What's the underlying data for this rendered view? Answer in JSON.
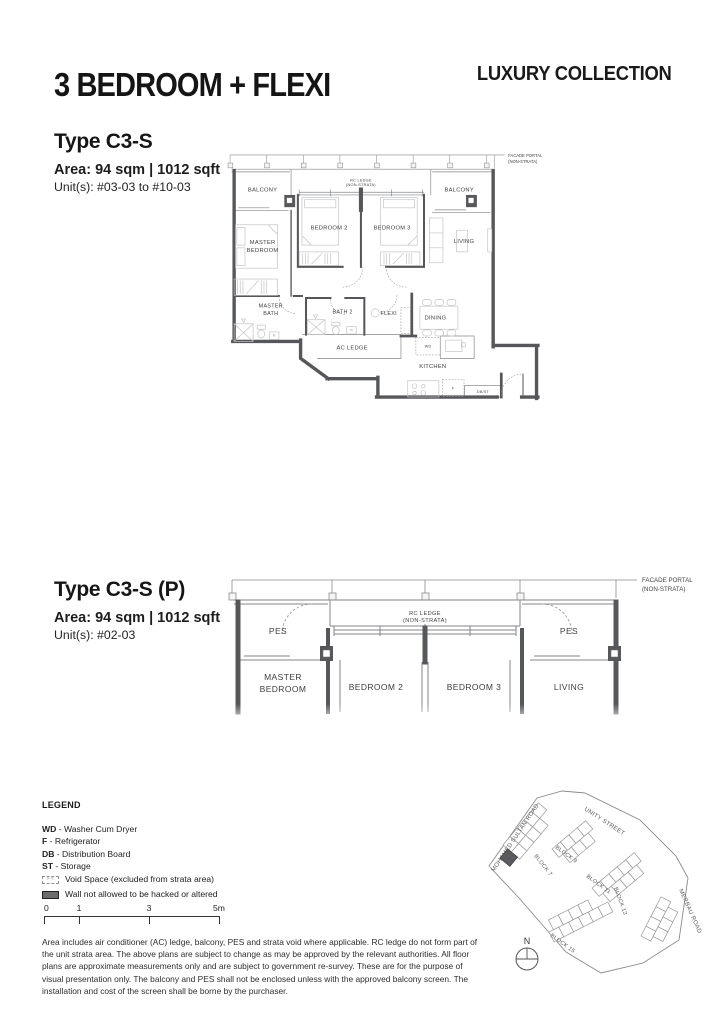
{
  "header": {
    "title": "3 BEDROOM + FLEXI",
    "collection": "LUXURY COLLECTION"
  },
  "plan1": {
    "type": "Type C3-S",
    "area": "Area: 94 sqm | 1012 sqft",
    "units": "Unit(s): #03-03 to #10-03",
    "labels": {
      "facade1": "FACADE PORTAL",
      "facade2": "(NON-STRATA)",
      "rc1": "RC LEDGE",
      "rc2": "(NON-STRATA)",
      "balcony_left": "BALCONY",
      "balcony_right": "BALCONY",
      "master1": "MASTER",
      "master2": "BEDROOM",
      "bedroom2": "BEDROOM 2",
      "bedroom3": "BEDROOM 3",
      "living": "LIVING",
      "mbath1": "MASTER",
      "mbath2": "BATH",
      "bath2": "BATH 2",
      "flexi": "FLEXI",
      "dining": "DINING",
      "ac_ledge": "AC LEDGE",
      "wd": "WD",
      "kitchen": "KITCHEN",
      "f": "F",
      "dbst": "DB/ST"
    }
  },
  "plan2": {
    "type": "Type C3-S (P)",
    "area": "Area: 94 sqm | 1012 sqft",
    "units": "Unit(s): #02-03",
    "labels": {
      "facade1": "FACADE PORTAL",
      "facade2": "(NON-STRATA)",
      "rc1": "RC LEDGE",
      "rc2": "(NON-STRATA)",
      "pes_left": "PES",
      "pes_right": "PES",
      "master1": "MASTER",
      "master2": "BEDROOM",
      "bedroom2": "BEDROOM 2",
      "bedroom3": "BEDROOM 3",
      "living": "LIVING"
    }
  },
  "legend": {
    "heading": "LEGEND",
    "items": [
      {
        "abbr": "WD",
        "rest": " - Washer Cum Dryer"
      },
      {
        "abbr": "F",
        "rest": " - Refrigerator"
      },
      {
        "abbr": "DB",
        "rest": " - Distribution Board"
      },
      {
        "abbr": "ST",
        "rest": " - Storage"
      }
    ],
    "void_glyph": "><",
    "void_space": "Void Space (excluded from strata area)",
    "wall_rule": "Wall not allowed to be hacked or altered"
  },
  "scalebar": {
    "labels": [
      "0",
      "1",
      "3",
      "5m"
    ]
  },
  "disclaimer": "Area includes air conditioner (AC) ledge, balcony, PES and strata void where applicable. RC ledge do not form part of the unit strata area. The above plans are subject to change as may be approved by the relevant authorities. All floor plans are approximate measurements only and are subject to government re-survey. These are for the purpose of visual presentation only. The balcony and PES shall not be enclosed unless with the approved balcony screen. The installation and cost of the screen shall be borne by the purchaser.",
  "sitemap": {
    "roads": {
      "mohamed": "MOHAMED SULTAN ROAD",
      "unity": "UNITY STREET",
      "merbau": "MERBAU ROAD"
    },
    "blocks": {
      "b7": "BLOCK 7",
      "b9": "BLOCK 9",
      "b11": "BLOCK 11",
      "b13": "BLOCK 13",
      "b15": "BLOCK 15"
    },
    "compass": "N"
  },
  "colors": {
    "wall": "#56575b",
    "thin_line": "#85868a",
    "furniture": "#c1c2c4",
    "label_text": "#3d3e40",
    "highlight_unit": "#5a5b5f"
  }
}
